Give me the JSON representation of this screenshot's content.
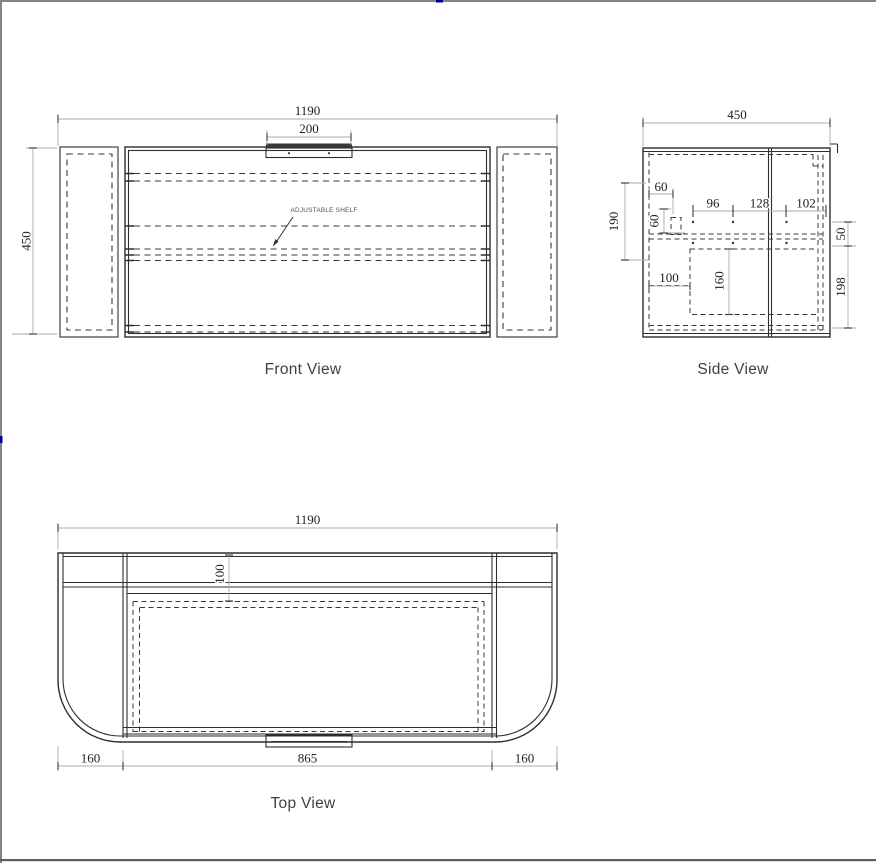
{
  "page": {
    "background": "#ffffff",
    "border_top_color": "#838383",
    "border_left_color": "#838383",
    "border_bottom_color": "#5d5d5d",
    "accent_marker_color": "#000090",
    "line_color": "#2e2e2e",
    "hidden_line_color": "#383838",
    "dimension_line_color": "#ababab",
    "dimension_text_color": "#1d1d1d",
    "label_text_color": "#3f3f3f"
  },
  "front_view": {
    "label": "Front View",
    "dim_width": "1190",
    "dim_handle": "200",
    "dim_height": "450",
    "annotation": "ADJUSTABLE SHELF"
  },
  "side_view": {
    "label": "Side View",
    "dim_depth": "450",
    "dim_left_height": "190",
    "dim_hinge_inset": "60",
    "dim_hinge_height": "60",
    "dim_span_a": "96",
    "dim_span_b": "128",
    "dim_span_c": "102",
    "dim_top_offset": "50",
    "dim_recess_width": "100",
    "dim_recess_height": "160",
    "dim_lower_height": "198"
  },
  "top_view": {
    "label": "Top View",
    "dim_width": "1190",
    "dim_back_depth": "100",
    "dim_left_end": "160",
    "dim_center": "865",
    "dim_right_end": "160"
  }
}
